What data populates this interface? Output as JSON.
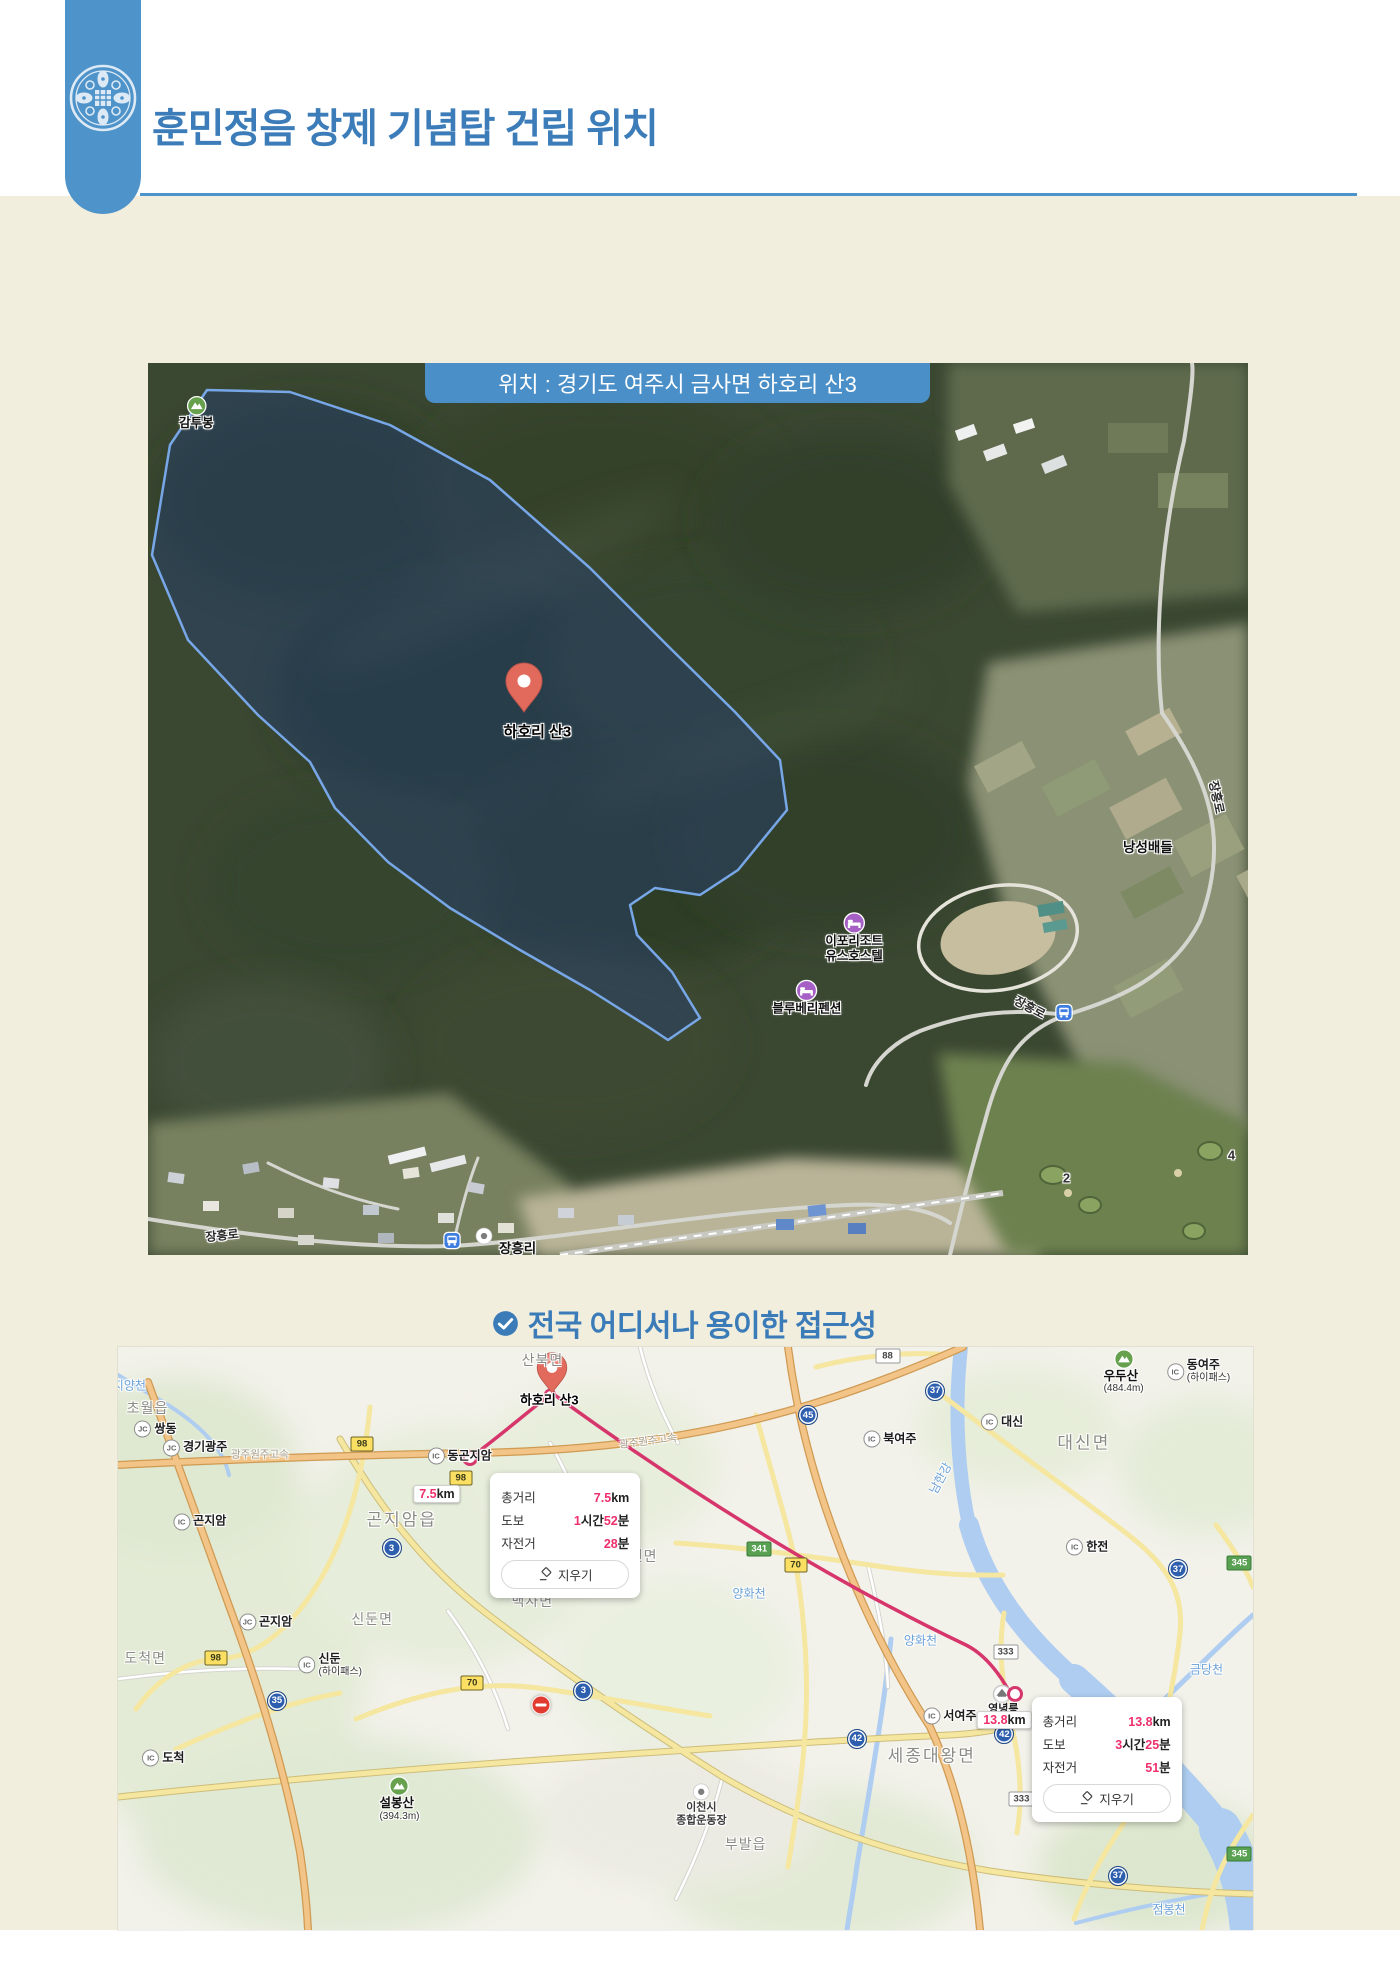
{
  "header": {
    "title": "훈민정음 창제 기념탑 건립 위치"
  },
  "satellite_map": {
    "banner": "위치 : 경기도 여주시 금사면 하호리 산3",
    "labels": [
      {
        "t": "micon",
        "text": "감투봉",
        "x": 4.4,
        "y": 5.6,
        "name": "peak-gamtubong"
      },
      {
        "t": "txt",
        "cls": "pin-label",
        "text": "하호리 산3",
        "x": 35.4,
        "y": 41.3,
        "name": "site-pin-label"
      },
      {
        "t": "poi",
        "icon": "bed",
        "lines": [
          "이포리조트",
          "유스호스텔"
        ],
        "x": 64.2,
        "y": 64.5,
        "name": "poi-ipo-resort-youth-hostel"
      },
      {
        "t": "poi",
        "icon": "bed",
        "lines": [
          "블루베리펜션"
        ],
        "x": 59.9,
        "y": 71.2,
        "name": "poi-blueberry-pension"
      },
      {
        "t": "txt",
        "cls": "sat",
        "text": "낭성배들",
        "x": 90.9,
        "y": 54.1,
        "name": "area-nangseongbaedeul"
      },
      {
        "t": "txt",
        "cls": "roadlbl",
        "text": "장흥로",
        "x": 97.2,
        "y": 48.7,
        "r": 78,
        "name": "road-jangheung-ro"
      },
      {
        "t": "txt",
        "cls": "roadlbl",
        "text": "장흥로",
        "x": 80.2,
        "y": 72.2,
        "r": 28,
        "name": "road-jangheung-ro"
      },
      {
        "t": "bus",
        "x": 83.3,
        "y": 73.1,
        "name": "bus-stop-icon"
      },
      {
        "t": "txt",
        "cls": "roadlbl",
        "text": "장흥로",
        "x": 6.7,
        "y": 97.8,
        "r": -6,
        "name": "road-jangheung-ro"
      },
      {
        "t": "bus",
        "x": 27.6,
        "y": 98.6,
        "name": "bus-stop-icon"
      },
      {
        "t": "poi",
        "icon": "dot",
        "lines": [],
        "x": 30.5,
        "y": 97.9,
        "name": "landmark-icon"
      },
      {
        "t": "two",
        "cls": "sat",
        "lines": [
          "장흥리",
          "마을회관"
        ],
        "x": 33.6,
        "y": 100.3,
        "name": "poi-jangheungri-hall"
      },
      {
        "t": "txt",
        "cls": "golf",
        "text": "2",
        "x": 83.5,
        "y": 91.4,
        "name": "golf-hole-2"
      },
      {
        "t": "txt",
        "cls": "golf",
        "text": "4",
        "x": 98.5,
        "y": 88.8,
        "name": "golf-hole-4"
      }
    ]
  },
  "access_heading": "전국 어디서나 용이한 접근성",
  "road_map": {
    "labels": [
      {
        "t": "txt",
        "cls": "area",
        "text": "산북면",
        "x": 37.4,
        "y": 2.2
      },
      {
        "t": "txt",
        "cls": "river",
        "text": "지양천",
        "x": 1.0,
        "y": 6.6
      },
      {
        "t": "txt",
        "cls": "area",
        "text": "초월읍",
        "x": 2.6,
        "y": 10.4
      },
      {
        "t": "ic",
        "badge": "JC",
        "text": "쌍동",
        "x": 3.3,
        "y": 14.1
      },
      {
        "t": "ic",
        "badge": "JC",
        "text": "경기광주",
        "x": 6.8,
        "y": 17.3
      },
      {
        "t": "txt",
        "cls": "roadname",
        "text": "광주원주고속",
        "x": 12.5,
        "y": 18.3
      },
      {
        "t": "ic",
        "badge": "IC",
        "text": "동곤지암",
        "x": 30.1,
        "y": 18.7
      },
      {
        "t": "txt",
        "cls": "roadname",
        "text": "광주원주고속",
        "x": 46.7,
        "y": 16.1,
        "r": -7
      },
      {
        "t": "badge",
        "cls": "b-yellow",
        "text": "98",
        "x": 21.5,
        "y": 16.6
      },
      {
        "t": "badge",
        "cls": "b-yellow",
        "text": "98",
        "x": 30.2,
        "y": 22.5
      },
      {
        "t": "kmbox",
        "num": "7.5",
        "unit": "km",
        "x": 28.1,
        "y": 25.2
      },
      {
        "t": "txt",
        "cls": "area area-lg",
        "text": "곤지암읍",
        "x": 25.0,
        "y": 29.3
      },
      {
        "t": "badge",
        "cls": "b-blue",
        "text": "3",
        "x": 24.1,
        "y": 34.5
      },
      {
        "t": "ic",
        "badge": "IC",
        "text": "곤지암",
        "x": 7.2,
        "y": 30.0
      },
      {
        "t": "two",
        "cls": "place",
        "lines": [
          "지암리조트",
          "스키장"
        ],
        "x": -2.6,
        "y": 38.4
      },
      {
        "t": "txt",
        "cls": "area",
        "text": "도척면",
        "x": 2.4,
        "y": 53.3
      },
      {
        "t": "badge",
        "cls": "b-yellow",
        "text": "98",
        "x": 8.6,
        "y": 53.3
      },
      {
        "t": "ic",
        "badge": "JC",
        "text": "곤지암",
        "x": 13.0,
        "y": 47.2
      },
      {
        "t": "ic",
        "badge": "IC",
        "text": "신둔",
        "sub": "(하이패스)",
        "x": 18.7,
        "y": 54.6
      },
      {
        "t": "badge",
        "cls": "b-blue",
        "text": "35",
        "x": 14.0,
        "y": 60.7
      },
      {
        "t": "ic",
        "badge": "IC",
        "text": "도척",
        "x": 4.0,
        "y": 70.5
      },
      {
        "t": "badge",
        "cls": "b-yellow",
        "text": "70",
        "x": 31.2,
        "y": 57.6
      },
      {
        "t": "txt",
        "cls": "area",
        "text": "신둔면",
        "x": 22.4,
        "y": 46.7
      },
      {
        "t": "txt",
        "cls": "area",
        "text": "백사면",
        "x": 36.5,
        "y": 43.6
      },
      {
        "t": "txt",
        "cls": "area",
        "text": "흥천면",
        "x": 45.7,
        "y": 35.8
      },
      {
        "t": "badge",
        "cls": "b-blue",
        "text": "3",
        "x": 41.0,
        "y": 59.0
      },
      {
        "t": "noentry",
        "x": 37.3,
        "y": 61.4
      },
      {
        "t": "badge",
        "cls": "b-yellow",
        "text": "70",
        "x": 59.7,
        "y": 37.4
      },
      {
        "t": "badge",
        "cls": "b-green",
        "text": "341",
        "x": 56.5,
        "y": 34.6
      },
      {
        "t": "txt",
        "cls": "river",
        "text": "양화천",
        "x": 55.6,
        "y": 42.2
      },
      {
        "t": "txt",
        "cls": "river",
        "text": "양화천",
        "x": 70.7,
        "y": 50.3
      },
      {
        "t": "ic",
        "badge": "IC",
        "text": "한전",
        "x": 85.4,
        "y": 34.3
      },
      {
        "t": "badge",
        "cls": "b-blue",
        "text": "37",
        "x": 93.4,
        "y": 38.1
      },
      {
        "t": "badge",
        "cls": "b-green",
        "text": "345",
        "x": 98.8,
        "y": 37.0
      },
      {
        "t": "txt",
        "cls": "area area-lg",
        "text": "대신면",
        "x": 85.1,
        "y": 16.1
      },
      {
        "t": "ic",
        "badge": "IC",
        "text": "대신",
        "x": 77.9,
        "y": 12.9
      },
      {
        "t": "ic",
        "badge": "IC",
        "text": "북여주",
        "x": 68.0,
        "y": 15.8
      },
      {
        "t": "txt",
        "cls": "river",
        "text": "남한강",
        "x": 72.4,
        "y": 22.5,
        "r": -62
      },
      {
        "t": "badge",
        "cls": "b-blue",
        "text": "45",
        "x": 60.8,
        "y": 11.7
      },
      {
        "t": "badge",
        "cls": "b-blue",
        "text": "37",
        "x": 72.0,
        "y": 7.5
      },
      {
        "t": "badge",
        "cls": "b-white",
        "text": "88",
        "x": 67.8,
        "y": 1.5
      },
      {
        "t": "ic",
        "badge": "IC",
        "text": "동여주",
        "sub": "(하이패스)",
        "x": 95.2,
        "y": 4.2
      },
      {
        "t": "micon",
        "text": "우두산",
        "sub": "(484.4m)",
        "x": 88.6,
        "y": 4.3
      },
      {
        "t": "txt",
        "cls": "pin-label",
        "text": "하호리 산3",
        "x": 38.0,
        "y": 8.9,
        "name": "site-pin-label"
      },
      {
        "t": "txt",
        "cls": "river",
        "text": "금당천",
        "x": 95.9,
        "y": 55.2
      },
      {
        "t": "ic",
        "badge": "IC",
        "text": "서여주",
        "x": 73.3,
        "y": 63.3
      },
      {
        "t": "badge",
        "cls": "b-blue",
        "text": "42",
        "x": 65.1,
        "y": 67.2
      },
      {
        "t": "badge",
        "cls": "b-blue",
        "text": "42",
        "x": 78.1,
        "y": 66.4
      },
      {
        "t": "txt",
        "cls": "area area-lg",
        "text": "세종대왕면",
        "x": 71.7,
        "y": 69.8
      },
      {
        "t": "txt",
        "cls": "place sm",
        "text": "영녕릉",
        "x": 78.0,
        "y": 62.0
      },
      {
        "t": "kmbox",
        "num": "13.8",
        "unit": "km",
        "x": 78.1,
        "y": 64.0
      },
      {
        "t": "badge",
        "cls": "b-white",
        "text": "333",
        "x": 78.2,
        "y": 52.3
      },
      {
        "t": "badge",
        "cls": "b-white",
        "text": "333",
        "x": 79.6,
        "y": 77.5
      },
      {
        "t": "badge",
        "cls": "b-green",
        "text": "345",
        "x": 98.8,
        "y": 87.0
      },
      {
        "t": "badge",
        "cls": "b-blue",
        "text": "37",
        "x": 88.1,
        "y": 90.7
      },
      {
        "t": "txt",
        "cls": "river",
        "text": "점봉천",
        "x": 92.6,
        "y": 96.4
      },
      {
        "t": "txt",
        "cls": "area",
        "text": "부발읍",
        "x": 55.3,
        "y": 85.2
      },
      {
        "t": "poi",
        "icon": "dot",
        "cls": "sm",
        "lines": [
          "이천시",
          "종합운동장"
        ],
        "x": 51.4,
        "y": 78.6
      },
      {
        "t": "micon",
        "text": "설봉산",
        "sub": "(394.3m)",
        "x": 24.8,
        "y": 77.6
      }
    ],
    "info_boxes": [
      {
        "x": 32.8,
        "y": 21.6,
        "rows": [
          {
            "label": "총거리",
            "parts": [
              [
                "7.5",
                1
              ],
              [
                "km",
                0
              ]
            ]
          },
          {
            "label": "도보",
            "parts": [
              [
                "1",
                1
              ],
              [
                "시간",
                0
              ],
              [
                "52",
                1
              ],
              [
                "분",
                0
              ]
            ]
          },
          {
            "label": "자전거",
            "parts": [
              [
                "28",
                1
              ],
              [
                "분",
                0
              ]
            ]
          }
        ],
        "button": "지우기"
      },
      {
        "x": 80.5,
        "y": 60.0,
        "rows": [
          {
            "label": "총거리",
            "parts": [
              [
                "13.8",
                1
              ],
              [
                "km",
                0
              ]
            ]
          },
          {
            "label": "도보",
            "parts": [
              [
                "3",
                1
              ],
              [
                "시간",
                0
              ],
              [
                "25",
                1
              ],
              [
                "분",
                0
              ]
            ]
          },
          {
            "label": "자전거",
            "parts": [
              [
                "51",
                1
              ],
              [
                "분",
                0
              ]
            ]
          }
        ],
        "button": "지우기"
      }
    ]
  }
}
